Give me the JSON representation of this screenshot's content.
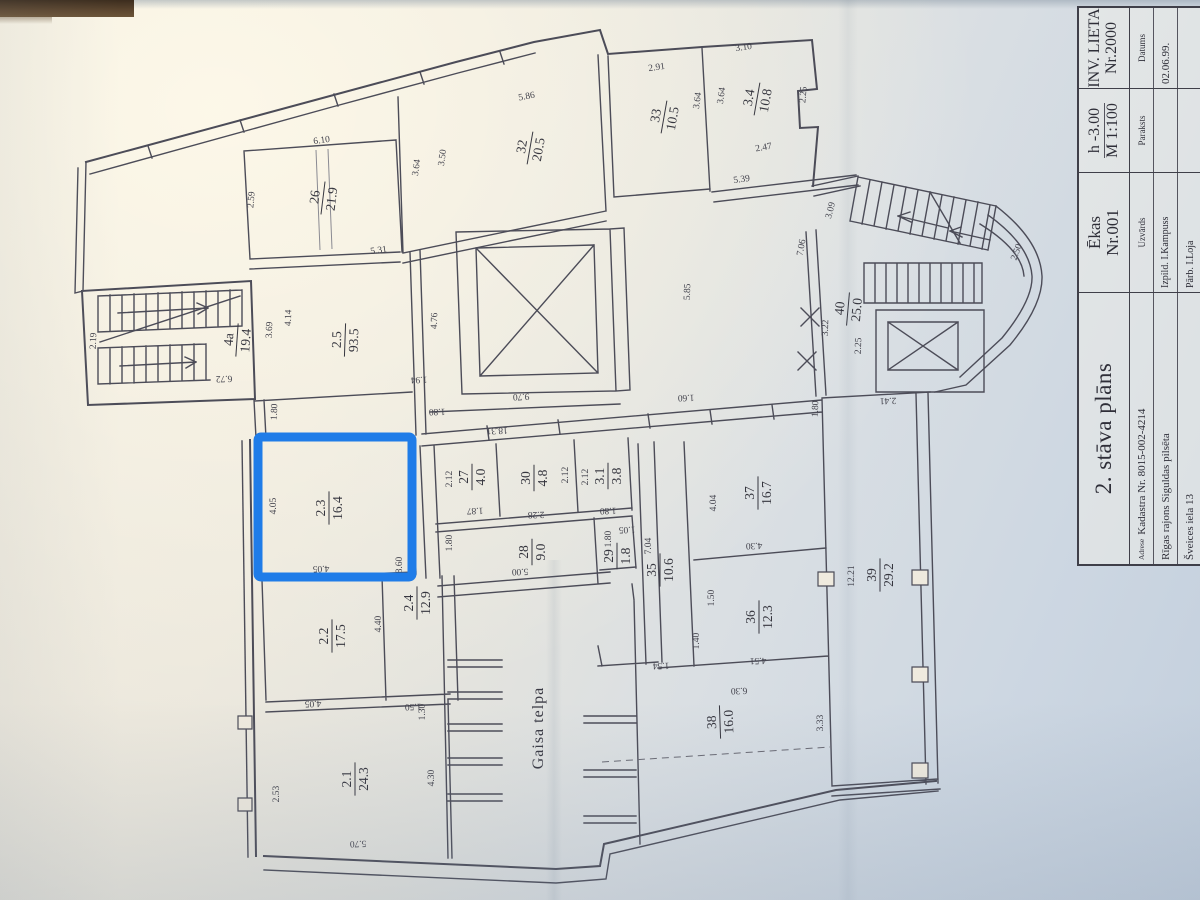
{
  "colors": {
    "highlight": "#1f7ce8",
    "ink": "#4c4c58",
    "paper": "#efeade"
  },
  "title_block": {
    "plan_title": "2. stāva plāns",
    "adrese_label": "Adrese",
    "kadastra": "Kadastra Nr. 8015-002-4214",
    "address_line2": "Rīgas rajons Siguldas pilsēta",
    "address_line3": "Šveices iela 13",
    "ekas_label": "Ēkas",
    "ekas_nr": "Nr.001",
    "uzvards_label": "Uzvārds",
    "izpild": "Izpild. I.Kampuss",
    "parb": "Pārb. I.Loja",
    "h_value": "h -3.00",
    "scale": "M 1:100",
    "paraksts_label": "Paraksts",
    "inv_lieta": "INV. LIETA",
    "inv_nr": "Nr.2000",
    "datums_label": "Datums",
    "datums_value": "02.06.99."
  },
  "plan": {
    "gaisa_telpa": "Gaisa telpa",
    "highlighted_room": "2.3",
    "rooms": [
      {
        "n": "26",
        "a": "21.9",
        "x": 323,
        "y": 198,
        "r": -83
      },
      {
        "n": "32",
        "a": "20.5",
        "x": 530,
        "y": 148,
        "r": -80
      },
      {
        "n": "33",
        "a": "10.5",
        "x": 664,
        "y": 117,
        "r": -80
      },
      {
        "n": "3.4",
        "a": "10.8",
        "x": 757,
        "y": 99,
        "r": -80
      },
      {
        "n": "4a",
        "a": "19.4",
        "x": 237,
        "y": 340,
        "r": -86
      },
      {
        "n": "2.5",
        "a": "93.5",
        "x": 345,
        "y": 340,
        "r": -88
      },
      {
        "n": "40",
        "a": "25.0",
        "x": 848,
        "y": 309,
        "r": -85
      },
      {
        "n": "2.3",
        "a": "16.4",
        "x": 329,
        "y": 508,
        "r": -90
      },
      {
        "n": "27",
        "a": "4.0",
        "x": 472,
        "y": 477,
        "r": -90
      },
      {
        "n": "30",
        "a": "4.8",
        "x": 534,
        "y": 478,
        "r": -90
      },
      {
        "n": "3.1",
        "a": "3.8",
        "x": 608,
        "y": 476,
        "r": -90
      },
      {
        "n": "28",
        "a": "9.0",
        "x": 532,
        "y": 552,
        "r": -90
      },
      {
        "n": "29",
        "a": "1.8",
        "x": 617,
        "y": 556,
        "r": -90
      },
      {
        "n": "35",
        "a": "10.6",
        "x": 660,
        "y": 570,
        "r": -90
      },
      {
        "n": "37",
        "a": "16.7",
        "x": 758,
        "y": 493,
        "r": -90
      },
      {
        "n": "36",
        "a": "12.3",
        "x": 759,
        "y": 617,
        "r": -90
      },
      {
        "n": "2.2",
        "a": "17.5",
        "x": 332,
        "y": 636,
        "r": -90
      },
      {
        "n": "2.4",
        "a": "12.9",
        "x": 417,
        "y": 603,
        "r": -90
      },
      {
        "n": "2.1",
        "a": "24.3",
        "x": 355,
        "y": 779,
        "r": -90
      },
      {
        "n": "38",
        "a": "16.0",
        "x": 720,
        "y": 722,
        "r": -92
      },
      {
        "n": "39",
        "a": "29.2",
        "x": 880,
        "y": 575,
        "r": -90
      }
    ],
    "dimensions": [
      {
        "v": "6.10",
        "x": 322,
        "y": 143,
        "r": -8
      },
      {
        "v": "2.59",
        "x": 254,
        "y": 200,
        "r": -85
      },
      {
        "v": "5.86",
        "x": 527,
        "y": 99,
        "r": -10
      },
      {
        "v": "2.91",
        "x": 657,
        "y": 70,
        "r": -8
      },
      {
        "v": "3.10",
        "x": 744,
        "y": 50,
        "r": -8
      },
      {
        "v": "3.64",
        "x": 419,
        "y": 168,
        "r": -82
      },
      {
        "v": "3.50",
        "x": 445,
        "y": 158,
        "r": -82
      },
      {
        "v": "3.64",
        "x": 700,
        "y": 101,
        "r": -82
      },
      {
        "v": "3.64",
        "x": 724,
        "y": 96,
        "r": -82
      },
      {
        "v": "2.25",
        "x": 806,
        "y": 95,
        "r": -85
      },
      {
        "v": "2.47",
        "x": 764,
        "y": 150,
        "r": -10
      },
      {
        "v": "5.39",
        "x": 742,
        "y": 182,
        "r": -8
      },
      {
        "v": "5.31",
        "x": 379,
        "y": 253,
        "r": -8
      },
      {
        "v": "2.19",
        "x": 96,
        "y": 341,
        "r": -88
      },
      {
        "v": "6.72",
        "x": 224,
        "y": 376,
        "r": 178
      },
      {
        "v": "3.69",
        "x": 272,
        "y": 330,
        "r": -88
      },
      {
        "v": "4.14",
        "x": 291,
        "y": 318,
        "r": -88
      },
      {
        "v": "1.80",
        "x": 277,
        "y": 412,
        "r": -88
      },
      {
        "v": "4.76",
        "x": 437,
        "y": 321,
        "r": -88
      },
      {
        "v": "1.94",
        "x": 419,
        "y": 377,
        "r": 178
      },
      {
        "v": "9.70",
        "x": 521,
        "y": 394,
        "r": 177
      },
      {
        "v": "18.31",
        "x": 497,
        "y": 428,
        "r": 177
      },
      {
        "v": "5.85",
        "x": 690,
        "y": 292,
        "r": -88
      },
      {
        "v": "3.09",
        "x": 833,
        "y": 211,
        "r": -75
      },
      {
        "v": "7.06",
        "x": 804,
        "y": 248,
        "r": -80
      },
      {
        "v": "2.50",
        "x": 1019,
        "y": 253,
        "r": -70
      },
      {
        "v": "3.22",
        "x": 828,
        "y": 328,
        "r": -88
      },
      {
        "v": "2.25",
        "x": 861,
        "y": 346,
        "r": -88
      },
      {
        "v": "2.41",
        "x": 888,
        "y": 398,
        "r": 178
      },
      {
        "v": "1.80",
        "x": 818,
        "y": 409,
        "r": -88
      },
      {
        "v": "1.80",
        "x": 437,
        "y": 409,
        "r": 178
      },
      {
        "v": "1.60",
        "x": 686,
        "y": 395,
        "r": 178
      },
      {
        "v": "2.12",
        "x": 452,
        "y": 479,
        "r": -90
      },
      {
        "v": "1.87",
        "x": 475,
        "y": 508,
        "r": 178
      },
      {
        "v": "2.12",
        "x": 568,
        "y": 475,
        "r": -90
      },
      {
        "v": "2.28",
        "x": 536,
        "y": 512,
        "r": 178
      },
      {
        "v": "2.12",
        "x": 588,
        "y": 477,
        "r": -90
      },
      {
        "v": "1.80",
        "x": 608,
        "y": 508,
        "r": 178
      },
      {
        "v": "1.80",
        "x": 452,
        "y": 543,
        "r": -90
      },
      {
        "v": "5.00",
        "x": 520,
        "y": 569,
        "r": 178
      },
      {
        "v": "1.80",
        "x": 611,
        "y": 539,
        "r": -90
      },
      {
        "v": "1.05",
        "x": 627,
        "y": 527,
        "r": 178
      },
      {
        "v": "7.04",
        "x": 651,
        "y": 546,
        "r": -90
      },
      {
        "v": "4.04",
        "x": 716,
        "y": 503,
        "r": -90
      },
      {
        "v": "4.30",
        "x": 754,
        "y": 543,
        "r": 178
      },
      {
        "v": "1.50",
        "x": 714,
        "y": 598,
        "r": -90
      },
      {
        "v": "1.40",
        "x": 699,
        "y": 641,
        "r": -90
      },
      {
        "v": "12.21",
        "x": 854,
        "y": 576,
        "r": -90
      },
      {
        "v": "3.33",
        "x": 823,
        "y": 723,
        "r": -90
      },
      {
        "v": "4.51",
        "x": 758,
        "y": 658,
        "r": 178
      },
      {
        "v": "6.30",
        "x": 739,
        "y": 688,
        "r": 178
      },
      {
        "v": "1.54",
        "x": 661,
        "y": 663,
        "r": 178
      },
      {
        "v": "4.05",
        "x": 276,
        "y": 506,
        "r": -90
      },
      {
        "v": "4.05",
        "x": 321,
        "y": 566,
        "r": 178
      },
      {
        "v": "8.60",
        "x": 402,
        "y": 565,
        "r": -90
      },
      {
        "v": "4.40",
        "x": 381,
        "y": 624,
        "r": -90
      },
      {
        "v": "4.05",
        "x": 313,
        "y": 701,
        "r": 178
      },
      {
        "v": "1.50",
        "x": 413,
        "y": 704,
        "r": 178
      },
      {
        "v": "1.30",
        "x": 425,
        "y": 712,
        "r": -90
      },
      {
        "v": "2.53",
        "x": 279,
        "y": 794,
        "r": -90
      },
      {
        "v": "4.30",
        "x": 434,
        "y": 778,
        "r": -90
      },
      {
        "v": "5.70",
        "x": 358,
        "y": 841,
        "r": 178
      }
    ]
  }
}
